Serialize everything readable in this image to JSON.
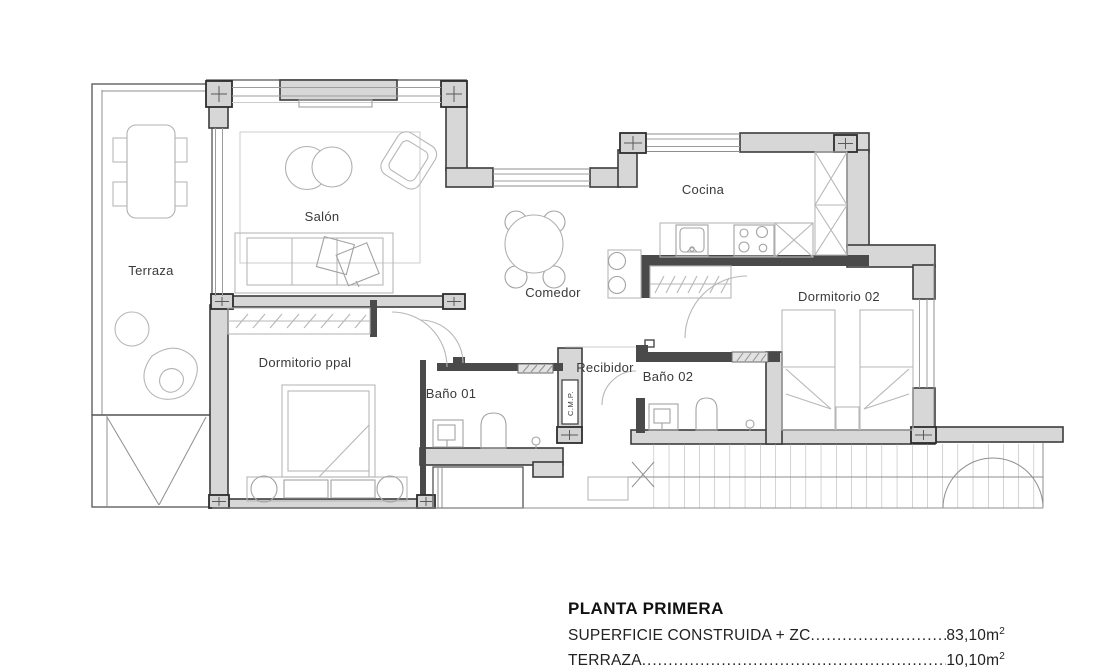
{
  "plan": {
    "rooms": {
      "terraza": {
        "label": "Terraza"
      },
      "salon": {
        "label": "Salón"
      },
      "cocina": {
        "label": "Cocina"
      },
      "comedor": {
        "label": "Comedor"
      },
      "dormitorio02": {
        "label": "Dormitorio 02"
      },
      "dormitorio_ppal": {
        "label": "Dormitorio ppal"
      },
      "bano01": {
        "label": "Baño 01"
      },
      "bano02": {
        "label": "Baño 02"
      },
      "recibidor": {
        "label": "Recibidor"
      },
      "cmp": {
        "label": "C.M.P."
      }
    },
    "colors": {
      "wall_fill": "#d7d7d7",
      "wall_dark": "#4a4a4a",
      "furniture": "#b7b7b7",
      "glazing": "#9d9d9d",
      "label_text": "#3a3a3a"
    }
  },
  "title_block": {
    "title": "PLANTA PRIMERA",
    "rows": [
      {
        "label": "SUPERFICIE CONSTRUIDA + ZC",
        "value": "83,10m",
        "sup": "2"
      },
      {
        "label": "TERRAZA",
        "value": "10,10m",
        "sup": "2"
      }
    ]
  }
}
